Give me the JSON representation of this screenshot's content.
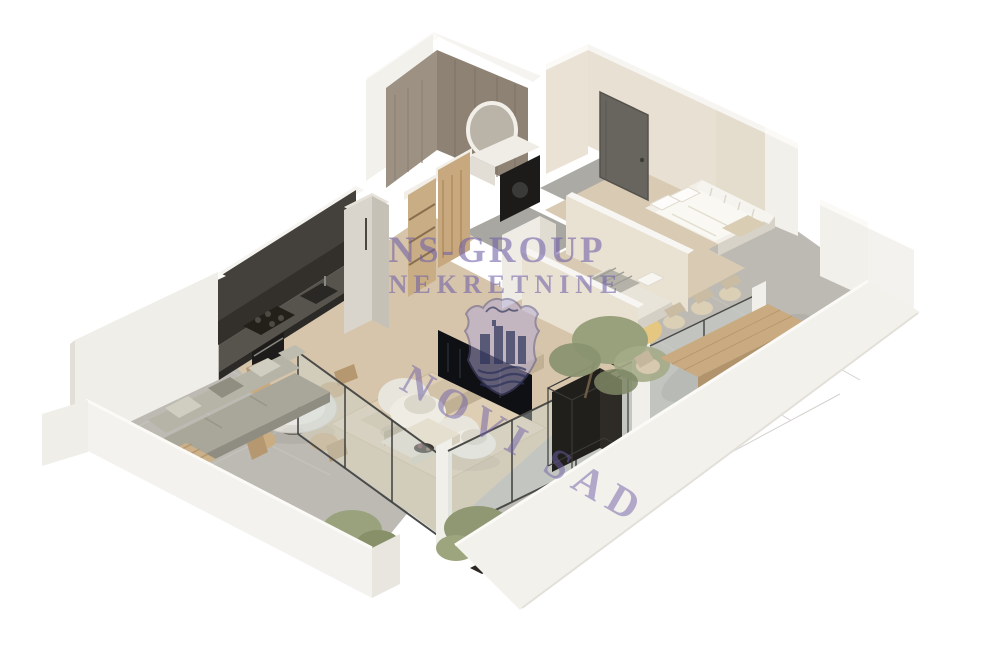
{
  "image": {
    "type": "isometric-3d-floorplan-render",
    "background": "#ffffff",
    "subject": "one-bedroom apartment with wrap-around terraces"
  },
  "watermark": {
    "line1": "NS-GROUP",
    "line2": "NEKRETNINE",
    "diagonal": "NOVI SAD",
    "text_color": "#6f60a8",
    "logo": "shield-crest",
    "logo_fill": "#b3a9d6",
    "logo_emblem_color": "#2b3158"
  },
  "palette": {
    "outer_wall": "#f0eee9",
    "interior_wall": "#e9e1d2",
    "wall_top": "#f8f6f2",
    "bathroom_tile": "#9d9183",
    "kitchen_cabinets": "#44403b",
    "terrace_tile": "#bcbab3",
    "living_carpet": "#d6c5ab",
    "wood": "#c9aa81",
    "glass": "#ccd6d2",
    "tree_foliage": "#98a17b",
    "planter_dark": "#211f1c",
    "yellow_rug": "#e8c87d",
    "entry_door": "#68655f"
  },
  "scene": {
    "rooms": [
      {
        "name": "bathroom",
        "features": [
          "tiled-walls",
          "round-mirror",
          "vanity",
          "washing-machine"
        ]
      },
      {
        "name": "entry-hall",
        "features": [
          "dark-entry-door",
          "gray-tile-floor",
          "open-wardrobe",
          "wood-door"
        ]
      },
      {
        "name": "kitchen",
        "features": [
          "dark-cabinet-run",
          "cooktop",
          "sink",
          "oven",
          "tall-fridge-unit",
          "round-glass-dining-table",
          "four-wood-chairs"
        ]
      },
      {
        "name": "living-room",
        "features": [
          "beige-carpet",
          "two-round-armchairs",
          "tv-on-low-bench",
          "ottoman-coffee-table",
          "glass-walls"
        ]
      },
      {
        "name": "bedroom-1",
        "features": [
          "double-bed",
          "white-pillows",
          "slat-railing"
        ]
      },
      {
        "name": "bedroom-2",
        "features": [
          "bed-gray-blanket",
          "round-yellow-rug"
        ]
      },
      {
        "name": "right-terrace",
        "features": [
          "long-wood-dining-table",
          "eight-chairs",
          "white-parapet",
          "potted-tree"
        ]
      },
      {
        "name": "left-terrace",
        "features": [
          "outdoor-sofa",
          "wood-side-table",
          "glass-balustrade",
          "potted-tree"
        ]
      }
    ]
  }
}
